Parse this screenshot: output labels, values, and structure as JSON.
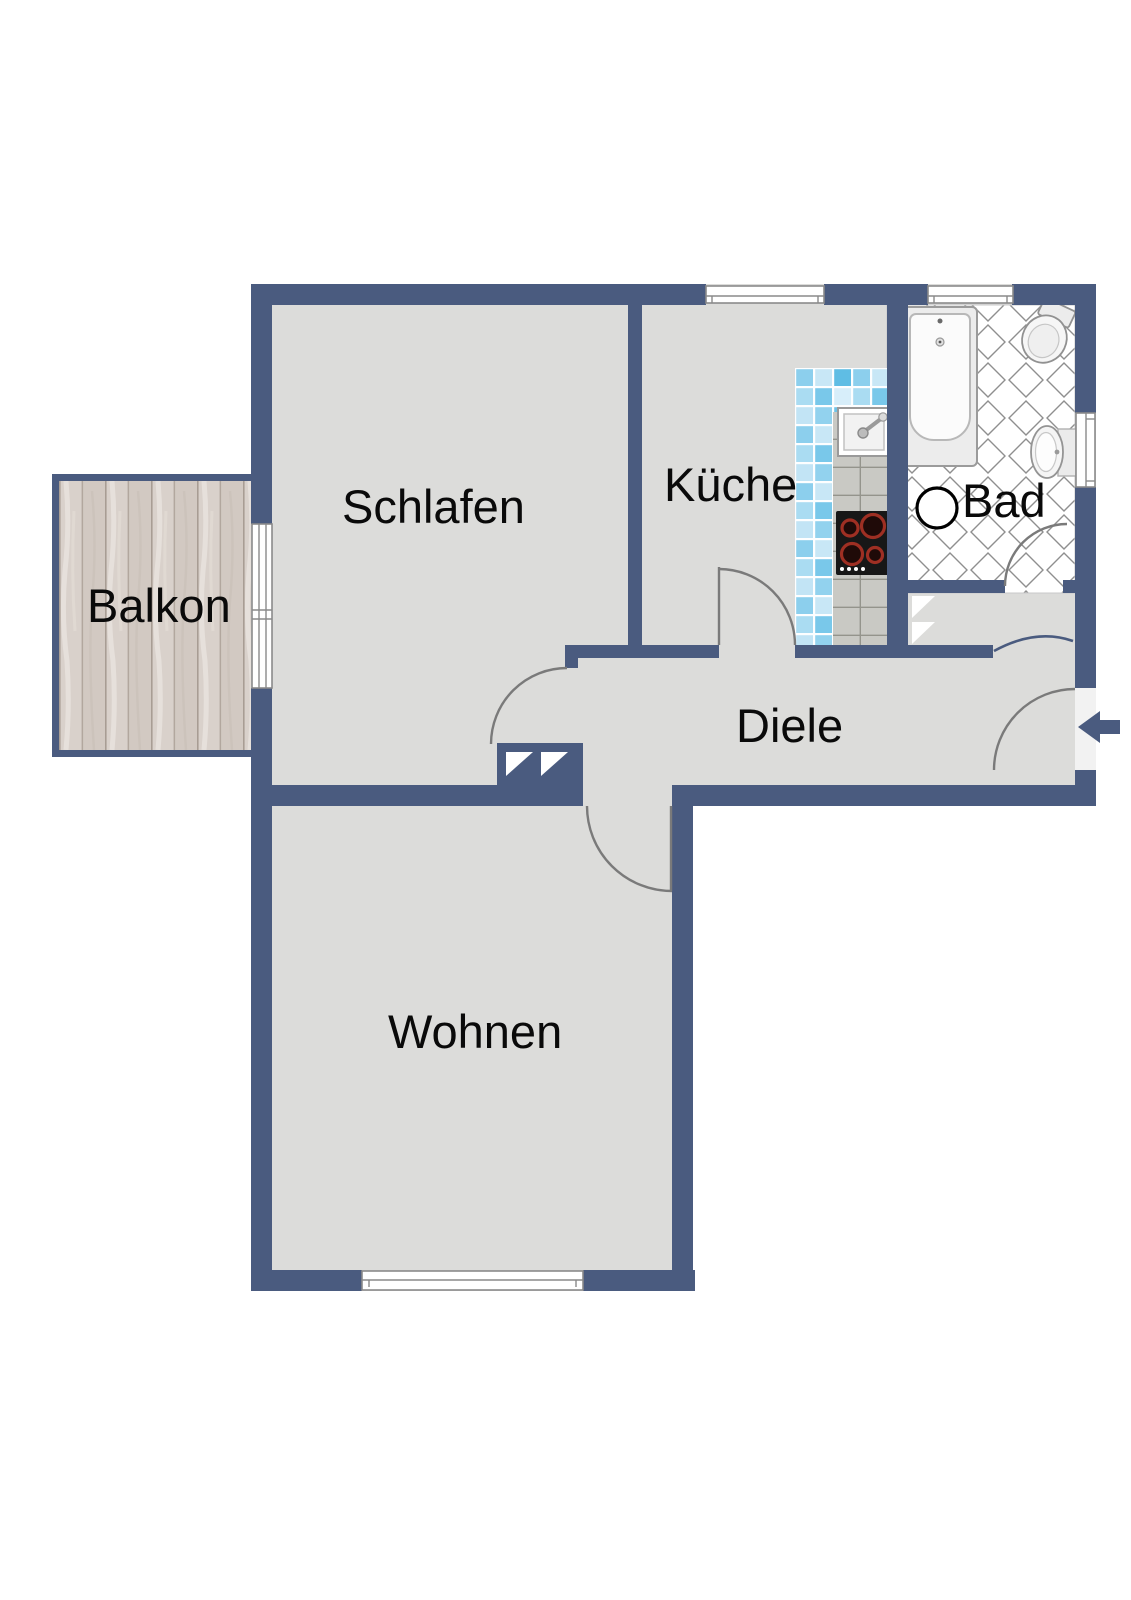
{
  "plan": {
    "rooms": {
      "schlafen": {
        "label": "Schlafen"
      },
      "kueche": {
        "label": "Küche"
      },
      "bad": {
        "label": "Bad"
      },
      "diele": {
        "label": "Diele"
      },
      "wohnen": {
        "label": "Wohnen"
      },
      "balkon": {
        "label": "Balkon"
      }
    }
  },
  "colors": {
    "wall": "#4a5b7f",
    "floor": "#dcdcda",
    "bath-tile-line": "#8f8f8f",
    "door-arc": "#7a7a7a",
    "label-text": "#0a0a0a",
    "mosaic-blue": "#7ac9ea",
    "counter-tile": "#c9c9c4",
    "balcony-wood": "#d9d1cb"
  },
  "icons": {
    "entrance_arrow": "arrow-left"
  }
}
